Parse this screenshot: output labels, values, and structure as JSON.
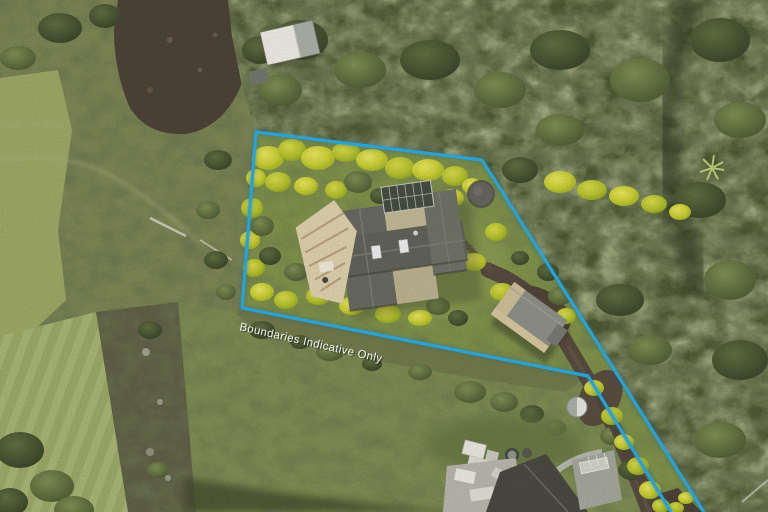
{
  "overlay": {
    "boundary_label": "Boundaries Indicative Only",
    "boundary_color": "#2BA8DA",
    "label_color": "#FFFFFF"
  },
  "palette": {
    "forest_green": "#49552F",
    "scrub_olive": "#7B8452",
    "pasture_green": "#9BA664",
    "meadow_green": "#7C8B50",
    "canopy_yellow": "#C9CE32",
    "dirt_brown": "#4A3F33",
    "driveway_brown": "#54463B",
    "roof_gray": "#63655C",
    "roof_tan": "#BFB693",
    "roof_white": "#E6E4DC",
    "boundary_cyan": "#2BA8DA"
  }
}
